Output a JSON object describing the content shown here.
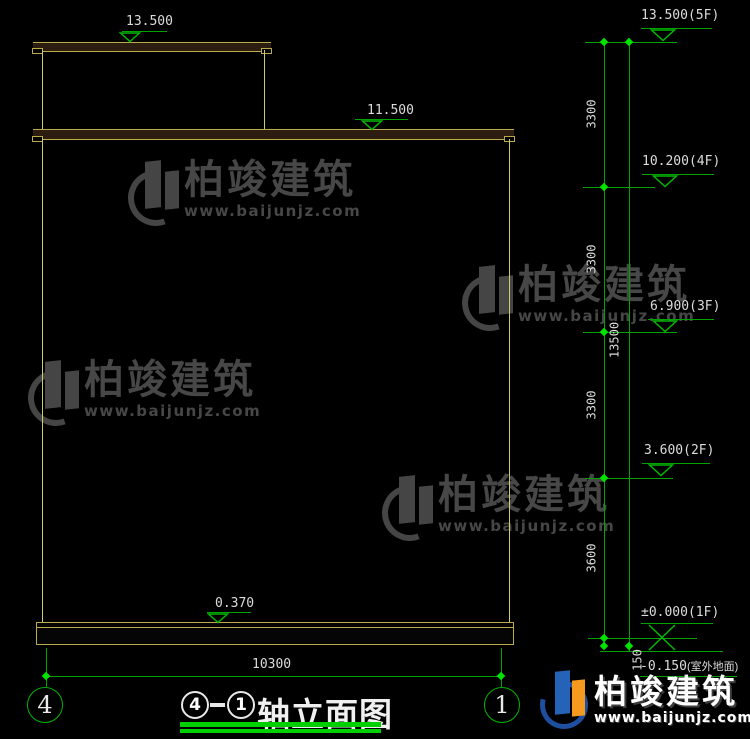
{
  "drawing": {
    "left_markers": {
      "tower_roof": "13.500",
      "main_roof": "11.500",
      "plinth": "0.370"
    },
    "levels": [
      {
        "label": "13.500(5F)"
      },
      {
        "label": "10.200(4F)"
      },
      {
        "label": "6.900(3F)"
      },
      {
        "label": "3.600(2F)"
      },
      {
        "label": "±0.000(1F)"
      },
      {
        "label": "-0.150",
        "suffix": "(室外地面)"
      }
    ],
    "vdims": [
      "3300",
      "3300",
      "3300",
      "3600",
      "150"
    ],
    "total_height_dim": "13500",
    "bottom_dimension": "10300",
    "axis_bubble_left": "4",
    "axis_bubble_right": "1",
    "title": {
      "axis_left": "4",
      "separator": "-",
      "axis_right": "1",
      "text": "轴立面图"
    }
  },
  "watermark": {
    "brand": "柏竣建筑",
    "url": "www.baijunjz.com"
  },
  "footer_logo": {
    "brand": "柏竣建筑",
    "url": "www.baijunjz.com"
  },
  "colors": {
    "background": "#000000",
    "cad_green": "#00a300",
    "tick_green": "#00e400",
    "wall_yellow": "#cbcb72",
    "slab_fill": "#2d1d11",
    "text_white": "#dcdcdc",
    "watermark_gray": "#474747",
    "logo_blue": "#2463b8",
    "logo_orange": "#f59a1e"
  }
}
